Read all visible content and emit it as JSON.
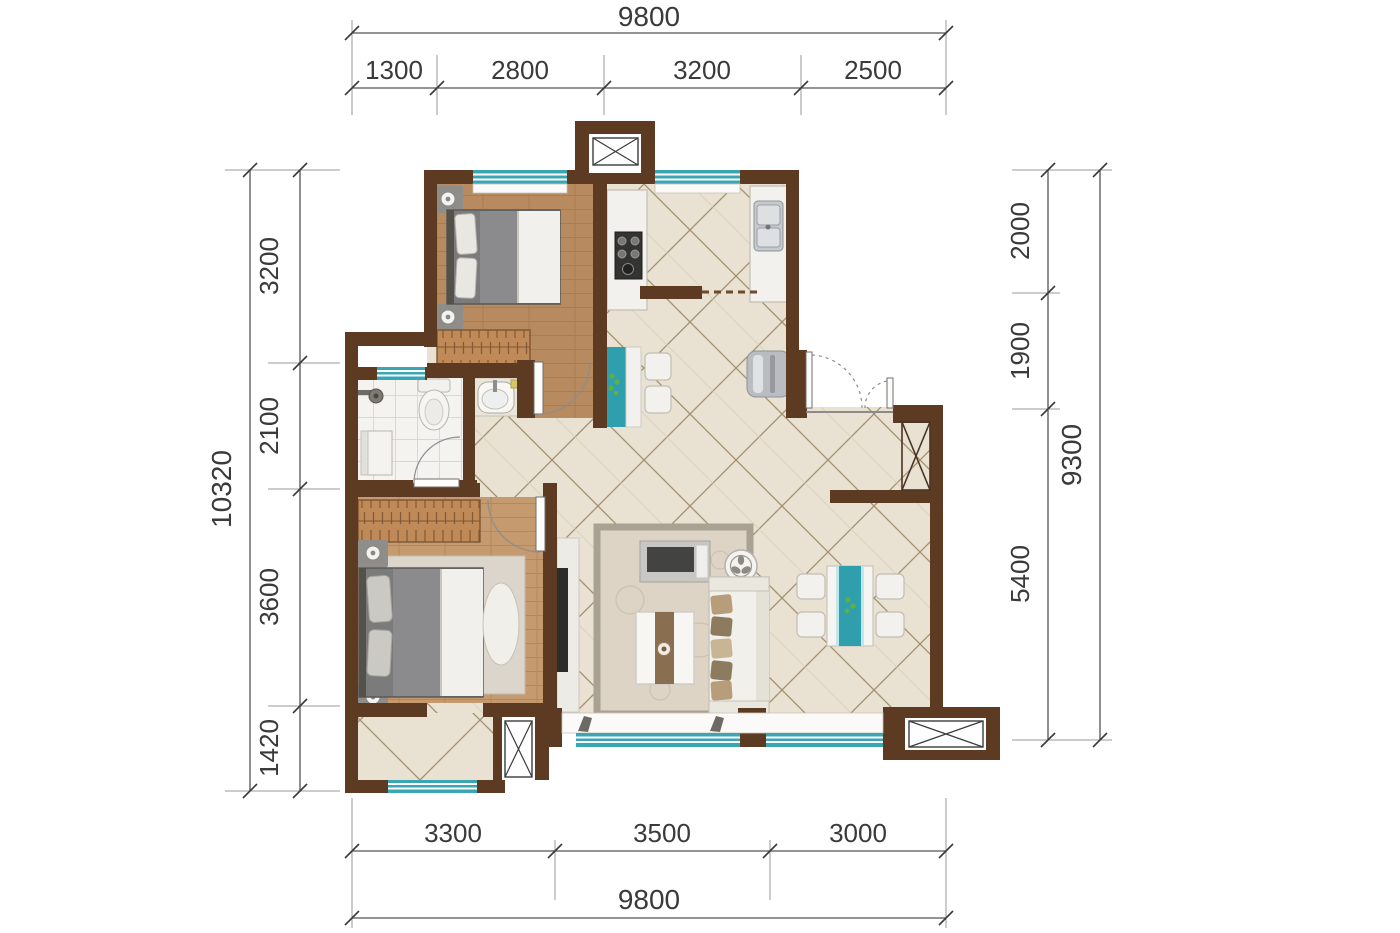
{
  "drawing": {
    "type": "residential-floor-plan",
    "unit": "mm",
    "dims": {
      "top": {
        "total": "9800",
        "segments": [
          "1300",
          "2800",
          "3200",
          "2500"
        ]
      },
      "bottom": {
        "total": "9800",
        "segments": [
          "3300",
          "3500",
          "3000"
        ]
      },
      "left": {
        "total": "10320",
        "segments": [
          "3200",
          "2100",
          "3600",
          "1420"
        ]
      },
      "right": {
        "total": "9300",
        "segments": [
          "2000",
          "1900",
          "5400"
        ]
      }
    }
  },
  "icons": {
    "shaft": "crossed-box",
    "bay_window": "crossed-box",
    "doors": "quarter-arc-swing"
  },
  "colors": {
    "wall": "#5d3a22",
    "window_teal": "#3aa6b4",
    "window_teal_light": "#bfe6ea",
    "wood_floor": "#b78a5f",
    "wood_floor_light": "#c49a6e",
    "tile_floor": "#e9e1d2",
    "tile_line": "#a3906f",
    "bath_tile": "#f5f3ef",
    "rug": "#ddd4c5",
    "accent_teal": "#2f9fae",
    "dim_text": "#3a3a3a"
  }
}
